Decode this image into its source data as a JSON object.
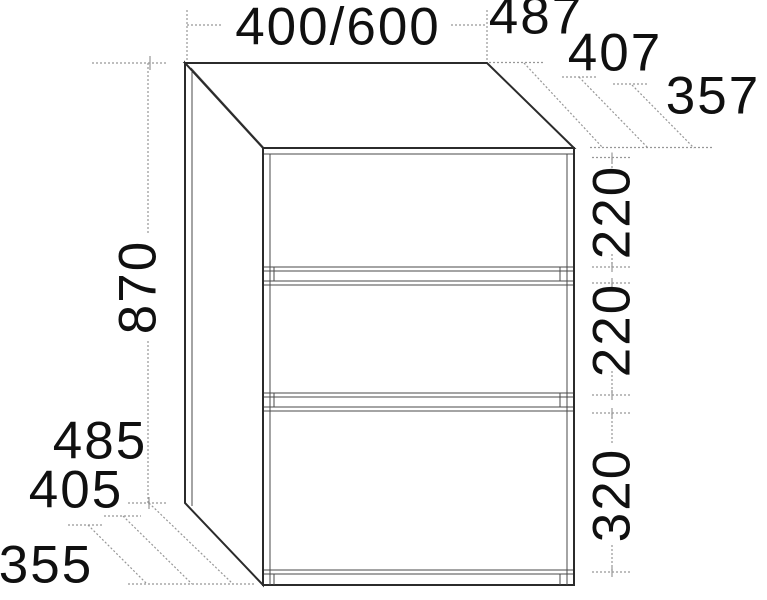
{
  "drawing": {
    "object": "three-drawer cabinet technical dimension drawing",
    "dims": {
      "width": "400/600",
      "depth_top": [
        "487",
        "407",
        "357"
      ],
      "height": "870",
      "drawer_heights": [
        "220",
        "220",
        "320"
      ],
      "depth_bottom": [
        "485",
        "405",
        "355"
      ]
    },
    "colors": {
      "edge": "#2b2b2b",
      "detail_line": "#4a4a4a",
      "dimension_line": "#979797",
      "text": "#101010",
      "background": "#ffffff"
    }
  }
}
